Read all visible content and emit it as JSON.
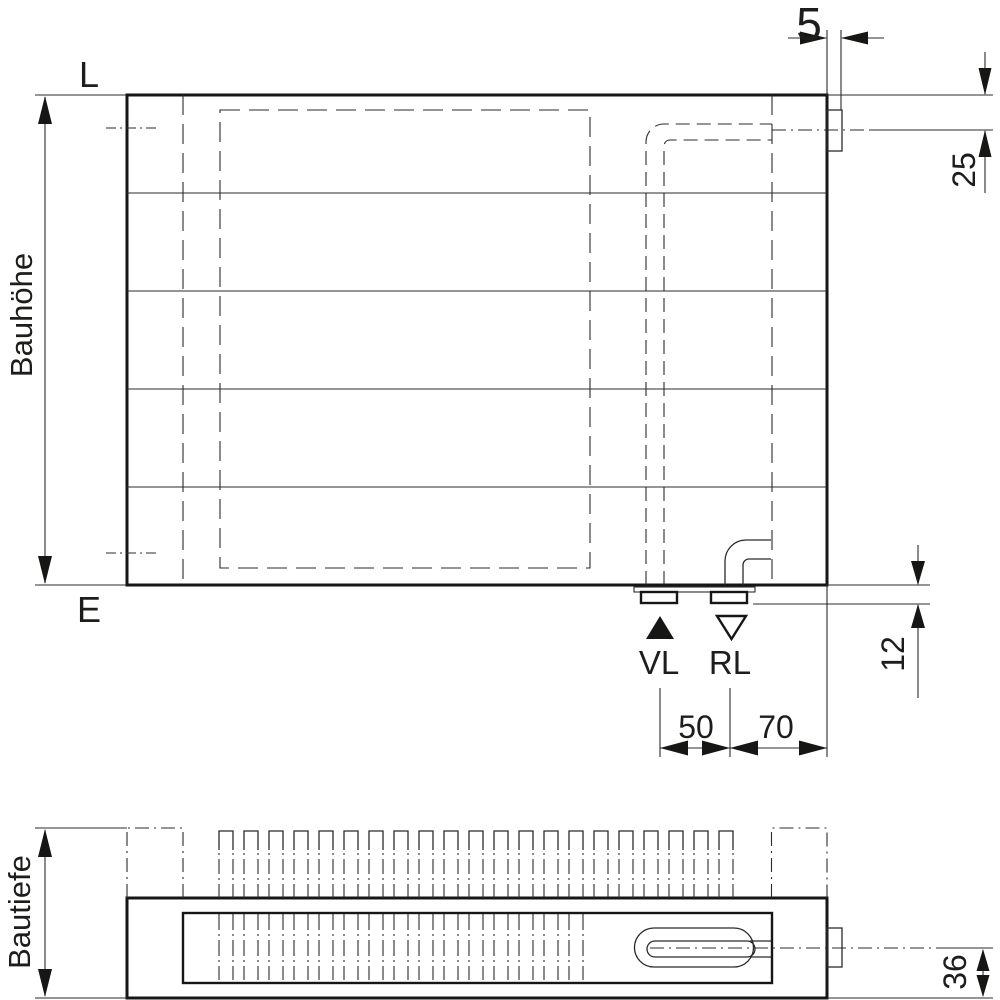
{
  "front_view": {
    "labels": {
      "vent_connection": "L",
      "drain_connection": "E",
      "height": "Bauhöhe",
      "flow": "VL",
      "return_flow": "RL"
    },
    "dimensions": {
      "connection_protrusion": "5",
      "top_connection_offset": "25",
      "bottom_connection_drop": "12",
      "flow_return_spacing": "50",
      "return_to_edge": "70"
    }
  },
  "plan_view": {
    "labels": {
      "depth": "Bautiefe"
    },
    "dimensions": {
      "connection_center_from_bottom": "36"
    }
  },
  "colors": {
    "line": "#1d1d1b",
    "background": "#ffffff"
  }
}
